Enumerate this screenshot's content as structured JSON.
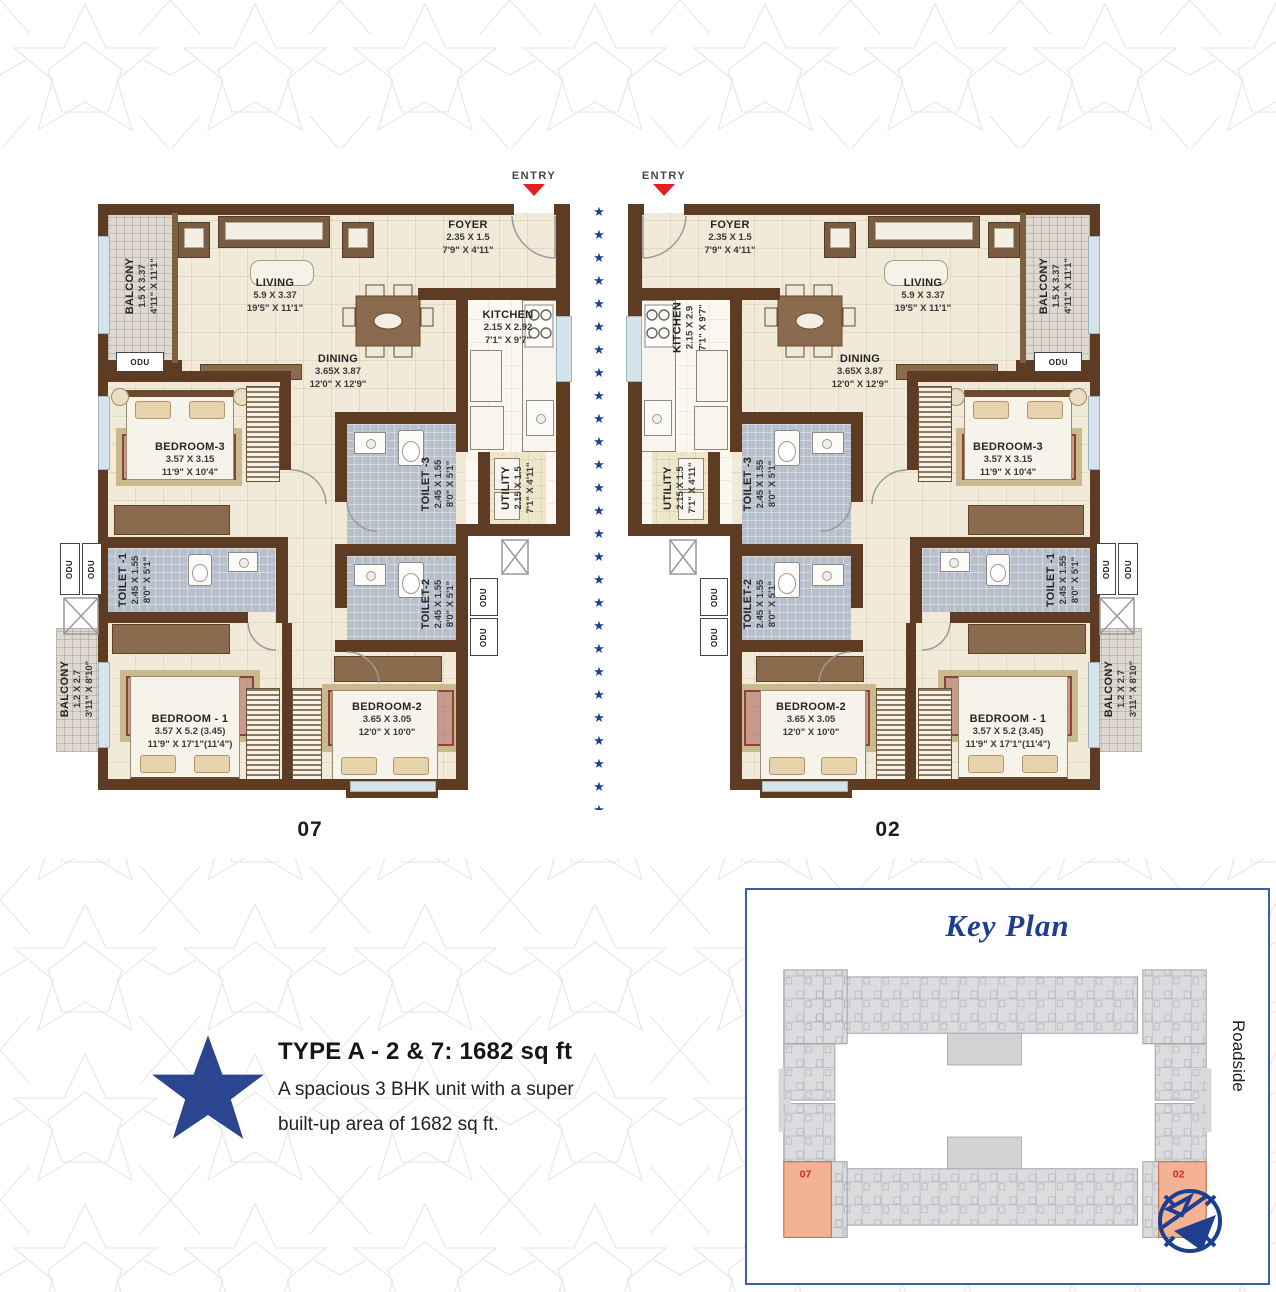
{
  "plans": {
    "entry_label": "ENTRY",
    "unit_left": "07",
    "unit_right": "02",
    "rooms": {
      "balcony_top": {
        "name": "BALCONY",
        "m": "1.5 X 3.37",
        "ft": "4'11\" X 11'1\""
      },
      "living": {
        "name": "LIVING",
        "m": "5.9 X 3.37",
        "ft": "19'5\" X 11'1\""
      },
      "foyer": {
        "name": "FOYER",
        "m": "2.35 X 1.5",
        "ft": "7'9\" X 4'11\""
      },
      "kitchen": {
        "name": "KITCHEN",
        "m": "2.15 X 2.92",
        "m_alt": "2.15 X 2.9",
        "ft": "7'1\" X 9'7\""
      },
      "dining": {
        "name": "DINING",
        "m": "3.65X 3.87",
        "ft": "12'0\" X 12'9\""
      },
      "utility": {
        "name": "UTILITY",
        "m": "2.15 X 1.5",
        "ft": "7'1\" X 4'11\""
      },
      "bedroom3": {
        "name": "BEDROOM-3",
        "m": "3.57 X 3.15",
        "ft": "11'9\" X 10'4\""
      },
      "toilet3": {
        "name": "TOILET -3",
        "m": "2.45 X 1.55",
        "ft": "8'0\" X 5'1\""
      },
      "toilet1": {
        "name": "TOILET -1",
        "m": "2.45 X 1.55",
        "ft": "8'0\" X 5'1\""
      },
      "toilet2": {
        "name": "TOILET-2",
        "m": "2.45 X 1.55",
        "ft": "8'0\" X 5'1\""
      },
      "bedroom1": {
        "name": "BEDROOM - 1",
        "m": "3.57 X 5.2 (3.45)",
        "ft": "11'9\" X 17'1\"(11'4\")"
      },
      "bedroom2": {
        "name": "BEDROOM-2",
        "m": "3.65 X 3.05",
        "ft": "12'0\" X 10'0\""
      },
      "balcony_bottom": {
        "name": "BALCONY",
        "m": "1.2 X 2.7",
        "ft": "3'11\" X 8'10\""
      },
      "odu": "ODU"
    }
  },
  "divider_stars": "★★★★★★★★★★★★★★★★★★★★★★★★★★★",
  "description": {
    "title": "TYPE A - 2 & 7: 1682 sq ft",
    "line1": "A spacious 3 BHK unit with a super",
    "line2": "built-up area of 1682 sq ft."
  },
  "key_plan": {
    "title": "Key Plan",
    "roadside": "Roadside",
    "unit_left_label": "07",
    "unit_right_label": "02"
  },
  "colors": {
    "accent_blue": "#1e3f8f",
    "wall_brown": "#5e3c24",
    "entry_red": "#e31e24",
    "highlight_orange": "#f4b295"
  }
}
